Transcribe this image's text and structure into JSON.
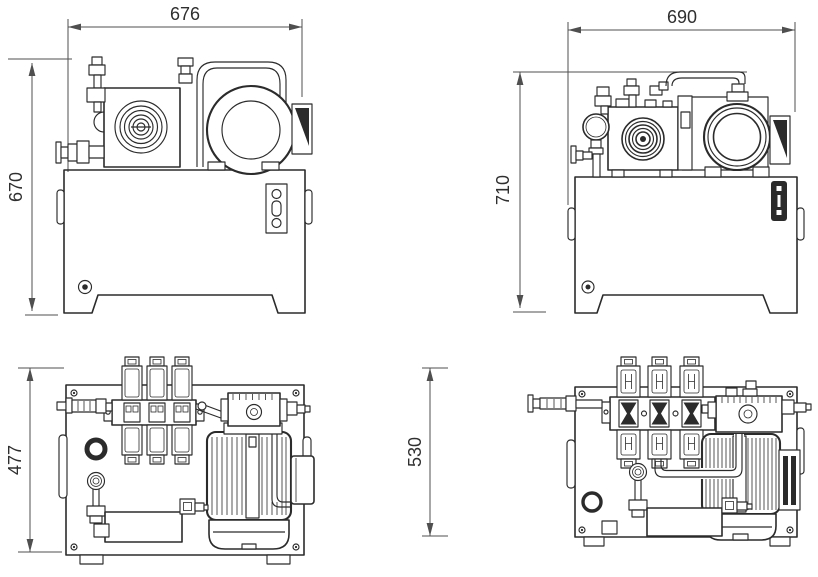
{
  "colors": {
    "line": "#2b2b2b",
    "dimension": "#4f4f4f",
    "background": "#ffffff"
  },
  "views": {
    "front_left": {
      "width": "676",
      "height": "670"
    },
    "front_right": {
      "width": "690",
      "height": "710"
    },
    "plan_left": {
      "depth": "477"
    },
    "plan_right": {
      "depth": "530"
    }
  }
}
